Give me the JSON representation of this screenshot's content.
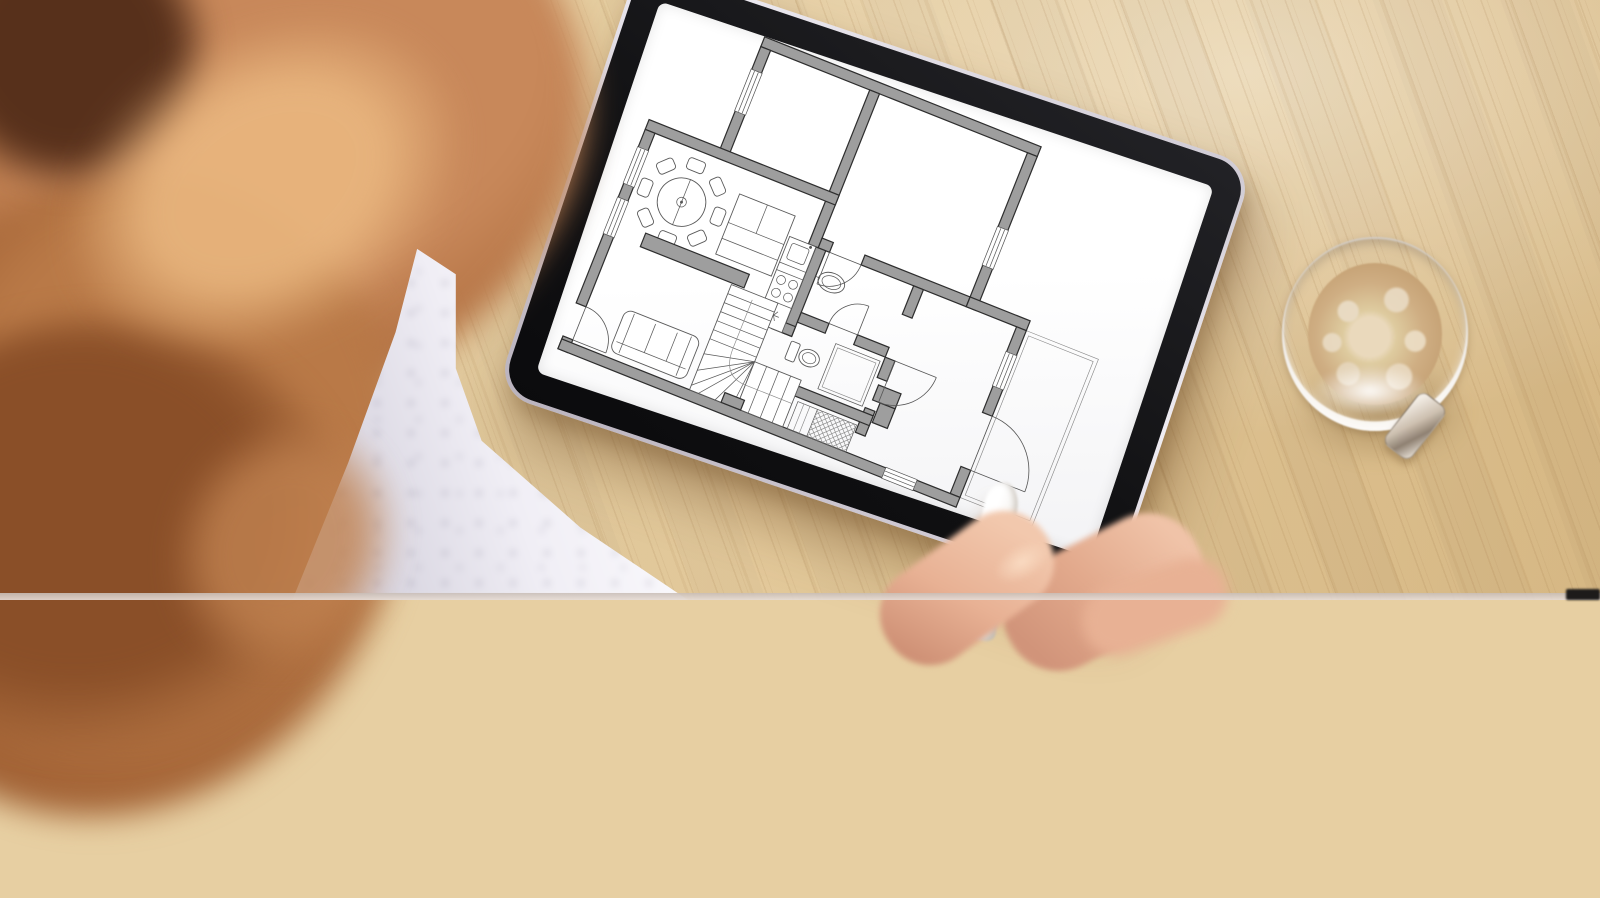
{
  "scene": {
    "description": "Over-the-shoulder photograph of a woman with wavy strawberry-blonde hair and a white polka-dot blouse reviewing an architectural floor plan on a tablet lying on a light wooden desk; her right hand holds a white stylus at the lower edge of the tablet and a glass cup of milky coffee stands to the right.",
    "setting": "light bamboo desk, top-down oblique view",
    "visible_text": []
  },
  "colors": {
    "wood": "#e7cfa2",
    "wood_streak": "#966c3c",
    "hair": "#b06f40",
    "hair_dark": "#57301b",
    "fabric": "#f0eef5",
    "fabric_dot": "#3c3858",
    "tablet_bezel": "#161618",
    "tablet_rim": "#e3dfe6",
    "screen": "#fdfdfd",
    "plan_wall": "#9e9e9e",
    "plan_line": "#2e2e2e",
    "coffee": "#cfae83",
    "coffee_foam": "#e9d9bd",
    "skin": "#e8b194",
    "stylus": "#f7f5f2"
  },
  "tablet": {
    "rotation_deg": 18.5,
    "screen_content": "architectural floor plan, gray walls on white"
  },
  "coffee_cup": {
    "type": "glass espresso cup with handle",
    "contents": "milky coffee with foam ring"
  },
  "floor_plan": {
    "viewbox": [
      -6,
      -6,
      680,
      470
    ],
    "wall_thickness": 13,
    "walls": [
      [
        95,
        0,
        368,
        13
      ],
      [
        95,
        13,
        13,
        31
      ],
      [
        95,
        98,
        13,
        63
      ],
      [
        240,
        13,
        13,
        205
      ],
      [
        0,
        148,
        253,
        13
      ],
      [
        450,
        13,
        13,
        99
      ],
      [
        450,
        162,
        13,
        56
      ],
      [
        253,
        205,
        15,
        13
      ],
      [
        310,
        205,
        140,
        13
      ],
      [
        450,
        205,
        80,
        13
      ],
      [
        517,
        218,
        13,
        34
      ],
      [
        517,
        296,
        13,
        36
      ],
      [
        517,
        404,
        13,
        36
      ],
      [
        250,
        218,
        13,
        114
      ],
      [
        236,
        319,
        27,
        13
      ],
      [
        263,
        300,
        37,
        13
      ],
      [
        338,
        300,
        42,
        13
      ],
      [
        380,
        218,
        13,
        38
      ],
      [
        380,
        313,
        13,
        27
      ],
      [
        380,
        380,
        13,
        33
      ],
      [
        250,
        386,
        143,
        13
      ],
      [
        0,
        161,
        13,
        24
      ],
      [
        0,
        232,
        13,
        20
      ],
      [
        0,
        299,
        13,
        93
      ],
      [
        0,
        436,
        13,
        17
      ],
      [
        0,
        440,
        432,
        13
      ],
      [
        472,
        440,
        58,
        13
      ],
      [
        385,
        348,
        30,
        20
      ],
      [
        395,
        368,
        20,
        26
      ]
    ],
    "walls_top": [
      [
        212,
        427,
        26,
        13
      ]
    ],
    "windows": [
      {
        "x": 95,
        "y": 44,
        "w": 13,
        "h": 54,
        "o": "v"
      },
      {
        "x": 0,
        "y": 185,
        "w": 13,
        "h": 47,
        "o": "v"
      },
      {
        "x": 0,
        "y": 252,
        "w": 13,
        "h": 47,
        "o": "v"
      },
      {
        "x": 450,
        "y": 112,
        "w": 13,
        "h": 50,
        "o": "v"
      },
      {
        "x": 517,
        "y": 252,
        "w": 13,
        "h": 44,
        "o": "v"
      },
      {
        "x": 432,
        "y": 440,
        "w": 40,
        "h": 13,
        "o": "h"
      }
    ],
    "doors": [
      {
        "path": "M13,392 A44,44 0 0 1 57,436",
        "r1": [
          13,
          436,
          13,
          392
        ],
        "r2": [
          13,
          436,
          57,
          436
        ]
      },
      {
        "path": "M310,218 A42,42 0 0 1 268,260",
        "r1": [
          268,
          218,
          268,
          260
        ],
        "r2": [
          268,
          218,
          310,
          218
        ]
      },
      {
        "path": "M338,262 A38,38 0 0 0 300,300",
        "r1": [
          338,
          300,
          338,
          262
        ],
        "r2": [
          338,
          300,
          300,
          300
        ]
      },
      {
        "path": "M448,313 A55,55 0 0 1 393,368",
        "r1": [
          393,
          313,
          448,
          313
        ],
        "r2": [
          393,
          313,
          393,
          368
        ]
      },
      {
        "path": "M530,332 A72,72 0 0 1 602,404",
        "r1": [
          530,
          404,
          530,
          332
        ],
        "r2": [
          530,
          404,
          602,
          404
        ]
      }
    ],
    "porch": {
      "outer": [
        530,
        218,
        96,
        222
      ],
      "inset": 5
    },
    "furniture": {
      "dining_table": {
        "cx": 75,
        "cy": 228,
        "r": 30,
        "chairs": 8,
        "chair_r": 48
      },
      "sofa_square": {
        "x": 138,
        "y": 192,
        "w": 74,
        "h": 80
      },
      "sideboard": {
        "x": 48,
        "y": 280,
        "w": 138,
        "h": 18
      },
      "kitchen": {
        "x": 215,
        "y": 218,
        "w": 35,
        "h": 114,
        "sink_y": 224,
        "stove_y": 272,
        "app_y": 316
      },
      "basin": {
        "cx": 284,
        "cy": 252,
        "rx": 17,
        "ry": 12
      },
      "toilet": {
        "tank": [
          265,
          337,
          12,
          24
        ],
        "cx": 293,
        "cy": 349
      },
      "shower": {
        "x": 317,
        "y": 320,
        "w": 59,
        "h": 60
      },
      "sofa3": {
        "x": 60,
        "y": 376,
        "w": 100,
        "h": 56
      },
      "stairs": {
        "fx": 170,
        "fy": 300,
        "fw": 62,
        "wy": 378,
        "wh": 62,
        "rw": 62,
        "treads": [
          312,
          324,
          336,
          348,
          360,
          372
        ]
      },
      "wardrobe": {
        "x": 300,
        "y": 404,
        "w": 78,
        "h": 36,
        "small_w": 26
      }
    }
  }
}
